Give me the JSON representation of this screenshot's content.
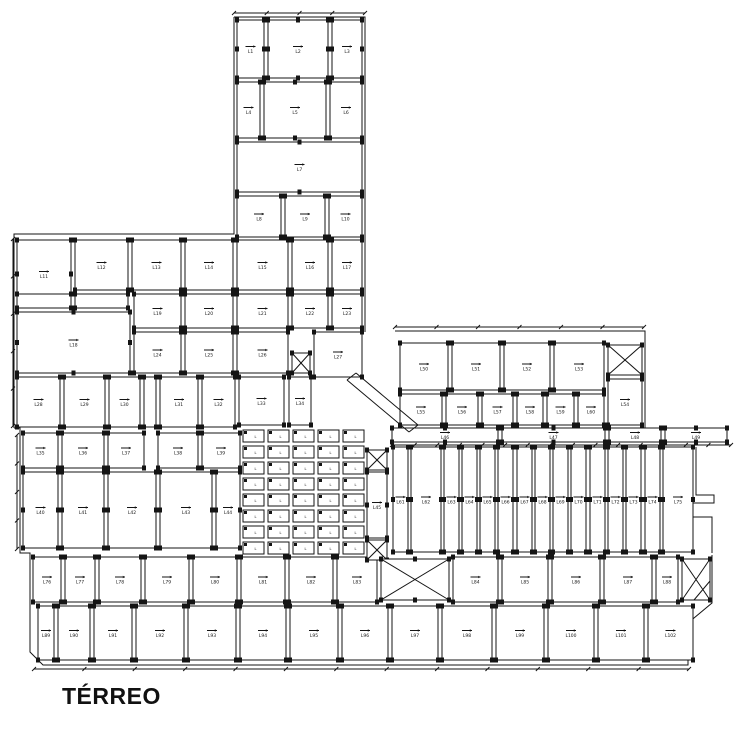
{
  "title": "TÉRREO",
  "drawing": {
    "ink": "#141414",
    "paper": "#ffffff",
    "rooms": [
      [
        237,
        20,
        27,
        58,
        "L1"
      ],
      [
        268,
        20,
        60,
        58,
        "L2"
      ],
      [
        332,
        20,
        30,
        58,
        "L3"
      ],
      [
        237,
        82,
        23,
        56,
        "L4"
      ],
      [
        264,
        82,
        62,
        56,
        "L5"
      ],
      [
        330,
        82,
        32,
        56,
        "L6"
      ],
      [
        237,
        142,
        125,
        50,
        "L7"
      ],
      [
        237,
        196,
        44,
        41,
        "L8"
      ],
      [
        285,
        196,
        40,
        41,
        "L9"
      ],
      [
        329,
        196,
        33,
        41,
        "L10"
      ],
      [
        17,
        240,
        54,
        68,
        "L11"
      ],
      [
        75,
        240,
        53,
        50,
        "L12"
      ],
      [
        132,
        240,
        49,
        50,
        "L13"
      ],
      [
        185,
        240,
        48,
        50,
        "L14"
      ],
      [
        237,
        240,
        51,
        50,
        "L15"
      ],
      [
        292,
        240,
        36,
        50,
        "L16"
      ],
      [
        332,
        240,
        30,
        50,
        "L17"
      ],
      [
        17,
        294,
        54,
        14,
        ""
      ],
      [
        75,
        294,
        53,
        14,
        ""
      ],
      [
        17,
        312,
        113,
        61,
        "L18"
      ],
      [
        134,
        294,
        47,
        34,
        "L19"
      ],
      [
        185,
        294,
        48,
        34,
        "L20"
      ],
      [
        237,
        294,
        51,
        34,
        "L21"
      ],
      [
        292,
        294,
        36,
        34,
        "L22"
      ],
      [
        332,
        294,
        30,
        34,
        "L23"
      ],
      [
        134,
        332,
        47,
        41,
        "L24"
      ],
      [
        185,
        332,
        48,
        41,
        "L25"
      ],
      [
        237,
        332,
        51,
        41,
        "L26"
      ],
      [
        314,
        332,
        48,
        45,
        "L27"
      ],
      [
        17,
        377,
        43,
        50,
        "L28"
      ],
      [
        64,
        377,
        41,
        50,
        "L29"
      ],
      [
        109,
        377,
        31,
        50,
        "L30"
      ],
      [
        144,
        377,
        12,
        50,
        ""
      ],
      [
        160,
        377,
        38,
        50,
        "L31"
      ],
      [
        202,
        377,
        33,
        50,
        "L32"
      ],
      [
        239,
        377,
        45,
        48,
        "L33"
      ],
      [
        289,
        377,
        22,
        48,
        "L34"
      ],
      [
        23,
        433,
        35,
        35,
        "L35"
      ],
      [
        62,
        433,
        42,
        35,
        "L36"
      ],
      [
        108,
        433,
        36,
        35,
        "L37"
      ],
      [
        158,
        433,
        40,
        35,
        "L38"
      ],
      [
        202,
        433,
        38,
        35,
        "L39"
      ],
      [
        23,
        472,
        35,
        76,
        "L40"
      ],
      [
        62,
        472,
        42,
        76,
        "L41"
      ],
      [
        108,
        472,
        48,
        76,
        "L42"
      ],
      [
        160,
        472,
        52,
        76,
        "L43"
      ],
      [
        216,
        472,
        24,
        76,
        "L44"
      ],
      [
        367,
        472,
        20,
        66,
        "L45"
      ],
      [
        392,
        428,
        106,
        14,
        "L46"
      ],
      [
        502,
        428,
        103,
        14,
        "L47"
      ],
      [
        609,
        428,
        52,
        14,
        "L48"
      ],
      [
        665,
        428,
        62,
        14,
        "L49"
      ],
      [
        400,
        343,
        48,
        47,
        "L50"
      ],
      [
        452,
        343,
        48,
        47,
        "L51"
      ],
      [
        504,
        343,
        46,
        47,
        "L52"
      ],
      [
        554,
        343,
        50,
        47,
        "L53"
      ],
      [
        608,
        379,
        34,
        46,
        "L54"
      ],
      [
        400,
        394,
        42,
        31,
        "L55"
      ],
      [
        446,
        394,
        32,
        31,
        "L56"
      ],
      [
        482,
        394,
        31,
        31,
        "L57"
      ],
      [
        517,
        394,
        26,
        31,
        "L58"
      ],
      [
        547,
        394,
        27,
        31,
        "L59"
      ],
      [
        578,
        394,
        26,
        31,
        "L60"
      ],
      [
        393,
        447,
        15,
        105,
        "L61"
      ],
      [
        411,
        447,
        30,
        105,
        "L62"
      ],
      [
        444,
        447,
        15,
        105,
        "L63"
      ],
      [
        462,
        447,
        15,
        105,
        "L64"
      ],
      [
        480,
        447,
        15,
        105,
        "L65"
      ],
      [
        498,
        447,
        15,
        105,
        "L66"
      ],
      [
        517,
        447,
        15,
        105,
        "L67"
      ],
      [
        535,
        447,
        15,
        105,
        "L68"
      ],
      [
        553,
        447,
        15,
        105,
        "L69"
      ],
      [
        571,
        447,
        15,
        105,
        "L70"
      ],
      [
        590,
        447,
        15,
        105,
        "L71"
      ],
      [
        608,
        447,
        15,
        105,
        "L72"
      ],
      [
        626,
        447,
        15,
        105,
        "L73"
      ],
      [
        645,
        447,
        15,
        105,
        "L74"
      ],
      [
        663,
        447,
        30,
        105,
        "L75"
      ],
      [
        33,
        557,
        28,
        45,
        "L76"
      ],
      [
        65,
        557,
        30,
        45,
        "L77"
      ],
      [
        99,
        557,
        42,
        45,
        "L78"
      ],
      [
        145,
        557,
        44,
        45,
        "L79"
      ],
      [
        193,
        557,
        44,
        45,
        "L80"
      ],
      [
        241,
        557,
        44,
        45,
        "L81"
      ],
      [
        289,
        557,
        44,
        45,
        "L82"
      ],
      [
        337,
        557,
        40,
        45,
        "L83"
      ],
      [
        453,
        557,
        45,
        45,
        "L84"
      ],
      [
        502,
        557,
        46,
        45,
        "L85"
      ],
      [
        552,
        557,
        48,
        45,
        "L86"
      ],
      [
        604,
        557,
        48,
        45,
        "L87"
      ],
      [
        656,
        557,
        22,
        45,
        "L88"
      ],
      [
        38,
        606,
        16,
        54,
        "L89"
      ],
      [
        58,
        606,
        32,
        54,
        "L90"
      ],
      [
        94,
        606,
        38,
        54,
        "L91"
      ],
      [
        136,
        606,
        48,
        54,
        "L92"
      ],
      [
        188,
        606,
        48,
        54,
        "L93"
      ],
      [
        240,
        606,
        46,
        54,
        "L94"
      ],
      [
        290,
        606,
        48,
        54,
        "L95"
      ],
      [
        342,
        606,
        46,
        54,
        "L96"
      ],
      [
        392,
        606,
        46,
        54,
        "L97"
      ],
      [
        442,
        606,
        50,
        54,
        "L98"
      ],
      [
        496,
        606,
        48,
        54,
        "L99"
      ],
      [
        548,
        606,
        46,
        54,
        "L100"
      ],
      [
        598,
        606,
        46,
        54,
        "L101"
      ],
      [
        648,
        606,
        45,
        54,
        "L102"
      ]
    ],
    "grids": [
      {
        "x": 243,
        "y": 430,
        "cols": 5,
        "rows": 8,
        "cw": 21,
        "ch": 12,
        "gx": 4,
        "gy": 4,
        "label": "L"
      }
    ],
    "xshafts": [
      [
        292,
        353,
        18,
        20
      ],
      [
        367,
        450,
        20,
        20
      ],
      [
        367,
        540,
        20,
        20
      ],
      [
        608,
        345,
        34,
        30
      ],
      [
        381,
        559,
        68,
        41
      ],
      [
        682,
        559,
        28,
        41
      ]
    ],
    "diagonals": [
      [
        347,
        380,
        409,
        432
      ],
      [
        356,
        373,
        418,
        425
      ],
      [
        347,
        380,
        356,
        373
      ],
      [
        409,
        432,
        418,
        425
      ],
      [
        710,
        581,
        694,
        600
      ]
    ],
    "outlines": [
      [
        [
          234,
          17
        ],
        [
          365,
          17
        ],
        [
          365,
          332
        ]
      ],
      [
        [
          234,
          17
        ],
        [
          234,
          234
        ],
        [
          14,
          234
        ],
        [
          14,
          428
        ]
      ],
      [
        [
          14,
          428
        ],
        [
          20,
          428
        ],
        [
          20,
          553
        ],
        [
          30,
          553
        ],
        [
          30,
          652
        ],
        [
          43,
          665
        ],
        [
          688,
          665
        ],
        [
          688,
          623
        ],
        [
          712,
          603
        ],
        [
          712,
          555
        ]
      ],
      [
        [
          395,
          331
        ],
        [
          645,
          331
        ],
        [
          645,
          440
        ]
      ],
      [
        [
          696,
          447
        ],
        [
          696,
          495
        ],
        [
          714,
          495
        ],
        [
          714,
          503
        ],
        [
          691,
          503
        ],
        [
          691,
          517
        ],
        [
          712,
          517
        ],
        [
          712,
          553
        ]
      ]
    ],
    "dimlines": [
      [
        234,
        13,
        365,
        13,
        4
      ],
      [
        13,
        239,
        13,
        426,
        5
      ],
      [
        392,
        445,
        731,
        445,
        15
      ],
      [
        34,
        669,
        689,
        669,
        13
      ],
      [
        395,
        327,
        644,
        327,
        6
      ],
      [
        17,
        435,
        17,
        549,
        4
      ]
    ]
  }
}
